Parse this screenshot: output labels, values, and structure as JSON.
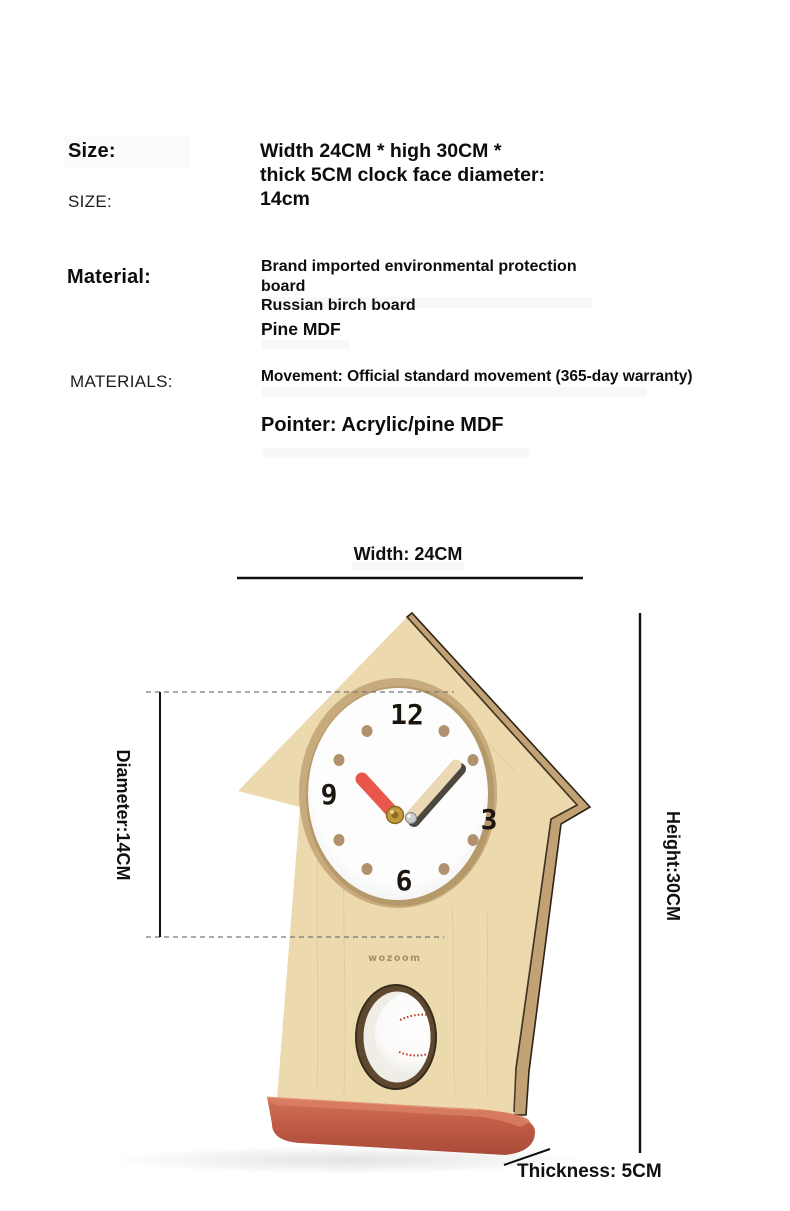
{
  "specs": {
    "size": {
      "label": "Size:",
      "label_caps": "SIZE:",
      "value": "Width 24CM * high 30CM *\nthick 5CM clock face diameter:\n14cm"
    },
    "material": {
      "label": "Material:",
      "label_caps": "MATERIALS:",
      "board_value": "Brand imported environmental protection board\nRussian birch board",
      "pine_value": "Pine MDF",
      "movement_value": "Movement: Official standard movement (365-day warranty)",
      "pointer_value": "Pointer: Acrylic/pine MDF"
    }
  },
  "dimensions": {
    "width_label": "Width: 24CM",
    "diameter_label": "Diameter:14CM",
    "height_label": "Height:30CM",
    "thickness_label": "Thickness: 5CM"
  },
  "clock": {
    "numeral_top": "12",
    "numeral_right": "3",
    "numeral_bottom": "6",
    "numeral_left": "9",
    "logo": "wozoom",
    "colors": {
      "wood": "#ecd9ad",
      "wood_edge": "#c2a274",
      "base_red": "#c15c46",
      "hour_hand_red": "#e8564c",
      "minute_hand_cream": "#ead9b4",
      "hour_dot_tan": "#b2926e",
      "numeral_dark": "#1b150e",
      "stitch_red": "#bf392d",
      "logo_tan": "#a98e62"
    }
  }
}
